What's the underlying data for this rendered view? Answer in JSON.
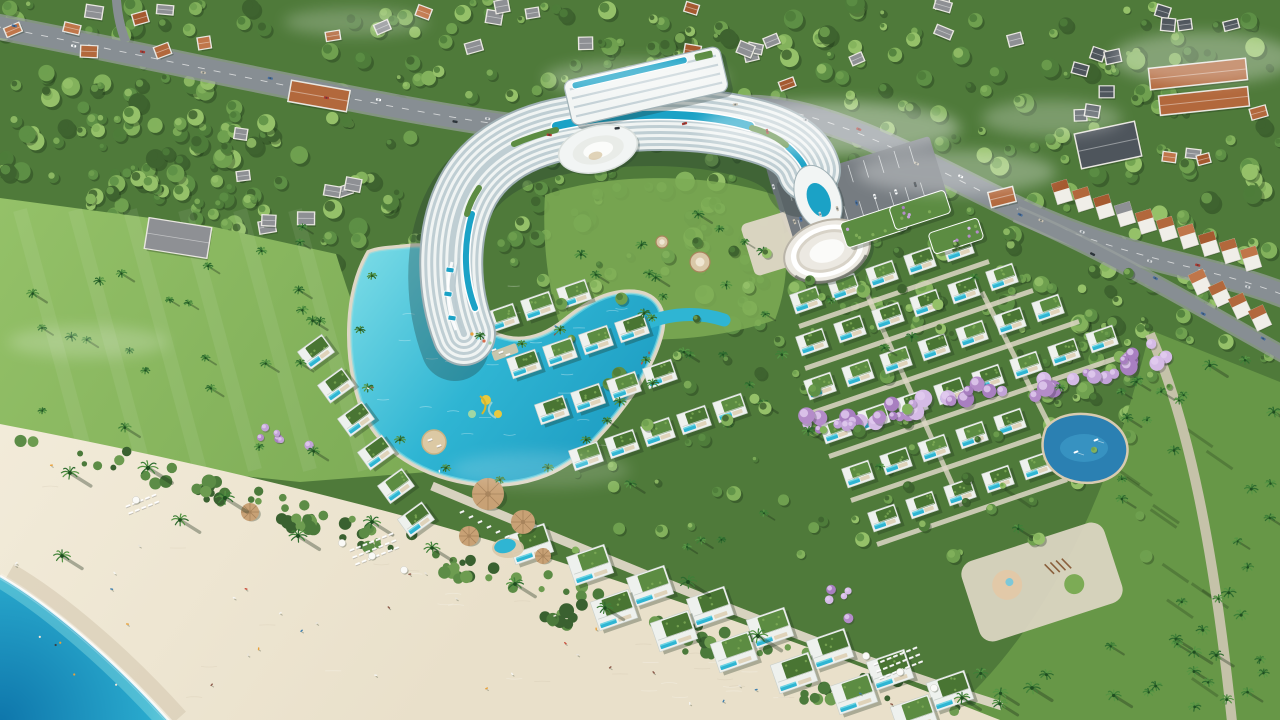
{
  "meta": {
    "type": "aerial-architectural-render",
    "subject": "beachfront resort complex with curved hotel, lagoon pools, villas, beach and sea"
  },
  "palette": {
    "forest_base": "#4f7a3a",
    "forest_cols": [
      "#3e632f",
      "#4e7c3a",
      "#5d8f45",
      "#6fa04f",
      "#83b25c",
      "#95c169"
    ],
    "shrub_cols": [
      "#3a6130",
      "#4b7a3b",
      "#5c8c46",
      "#6d9c50"
    ],
    "lawn": "#7cab55",
    "lawn_light": "#94c168",
    "lawn_dark": "#679747",
    "sand": "#e9e0ca",
    "sand_light": "#f2ebd9",
    "sand_wet": "#d9cdb6",
    "sand_grain": "#c9bda6",
    "sea_deep": "#0e76ab",
    "sea_mid": "#29a9cd",
    "sea_shallow": "#8fe2e4",
    "foam": "#ffffff",
    "road": "#878e93",
    "road_edge": "#9aa19e",
    "lane": "#e8eaea",
    "path": "#cfc7b4",
    "path_light": "#ded7c6",
    "villa_white": "#eef1ee",
    "villa_edge": "#c9d0cc",
    "deck": "#d9c8a8",
    "hotel_white": "#f2f5f4",
    "hotel_glass": "#bccbd1",
    "hotel_edge": "#9fb0b5",
    "rooftop_pool": "#1ba2c6",
    "pool": "#2fb5d3",
    "pool_light": "#7adbe6",
    "lagoon_deep": "#1895bd",
    "green_roof": "#5c8c42",
    "green_roof_dark": "#497533",
    "green_roof_light": "#7fad58",
    "purple_cols": [
      "#c2a3d8",
      "#b48cc9",
      "#d5bbe6",
      "#a87fc0"
    ],
    "tan": "#c8a175",
    "tan_dark": "#a8845c",
    "orange_roofs": [
      "#b2683c",
      "#a55a30",
      "#c0764a"
    ],
    "gray_roof": "#8e9094",
    "dark_roof": "#4e555c",
    "house_base": "#e9e7e1",
    "pond_deep": "#2b80b2",
    "pond_light": "#3f9ecb",
    "shadow": "rgba(25,45,22,0.35)",
    "car_cols": [
      "#ffffff",
      "#d8dadc",
      "#2e3338",
      "#b33a30",
      "#4a6f9e",
      "#c8c0b0"
    ],
    "people_cols": [
      "#e8e4da",
      "#c94f3e",
      "#e8a13c",
      "#3f7fae",
      "#f5f5f2",
      "#8c5a4a"
    ],
    "slide_yellow": "#e8c93e",
    "mist": "#ffffff"
  },
  "scene": {
    "seed": 7,
    "beach_d": "M 0,424 C 240,470 430,520 560,562 C 720,614 880,672 1005,722 L 0,722 Z",
    "sea_d": "M 0,576 C 52,606 118,664 170,722 L 0,722 Z",
    "shore_d": "M 0,576 C 52,606 118,664 170,722",
    "lawn_d": "M 0,198 L 210,226 L 336,254 C 360,330 392,420 428,472 L 300,482 L 150,466 L 0,436 Z",
    "corner_lawn_d": "M 1150,330 L 1280,382 L 1280,722 L 940,722 C 1042,640 1110,498 1150,330 Z",
    "courtyard_d": "M 545,195 C 600,175 700,170 775,195 C 790,240 790,280 775,320 C 700,345 620,345 560,325 C 548,290 542,240 545,195 Z",
    "lagoon_d": "M 370,254 C 348,292 346,352 362,402 C 378,450 426,476 478,482 C 530,486 566,468 594,438 C 622,408 648,372 658,338 C 666,312 656,296 634,294 C 608,292 586,306 566,322 C 546,338 524,346 500,338 C 474,330 458,306 456,278 C 454,256 436,246 412,248 C 394,250 380,250 370,254 Z",
    "lagoon_channel_d": "M 630,330 C 662,314 694,310 724,320",
    "hotel": {
      "band_d": "M 464,334 C 448,292 446,238 464,198 C 480,162 514,140 558,130 C 622,116 700,114 760,132 C 790,141 804,154 809,170",
      "roof_pools": [
        {
          "d": "M 556,126 C 618,112 696,110 750,126",
          "w": 8
        },
        {
          "d": "M 472,214 C 463,246 464,280 475,308",
          "w": 6
        },
        {
          "d": "M 788,147 C 797,155 803,162 806,170",
          "w": 6
        }
      ],
      "roof_greens": [
        {
          "d": "M 514,144 C 530,137 544,133 556,130",
          "w": 6
        },
        {
          "d": "M 752,128 C 766,132 778,138 786,145",
          "w": 6
        },
        {
          "d": "M 479,188 C 473,197 469,205 467,214",
          "w": 6
        }
      ],
      "wing": {
        "cx": 646,
        "cy": 86,
        "w": 160,
        "h": 46,
        "ang": -13
      },
      "shell": {
        "cx": 598,
        "cy": 149,
        "rx": 40,
        "ry": 23,
        "ang": -13
      },
      "podium": {
        "cx": 818,
        "cy": 198,
        "rx": 22,
        "ry": 34,
        "ang": -22
      }
    },
    "amphitheater": {
      "cx": 827,
      "cy": 251,
      "ang": -18
    },
    "roof_gardens": [
      {
        "x": 874,
        "y": 226,
        "w": 64,
        "h": 26
      },
      {
        "x": 920,
        "y": 210,
        "w": 58,
        "h": 24
      },
      {
        "x": 956,
        "y": 236,
        "w": 52,
        "h": 22
      }
    ],
    "parking": {
      "cx": 862,
      "cy": 190,
      "w": 160,
      "h": 64,
      "ang": -17
    },
    "pond_d": "M 1046,428 C 1038,448 1044,468 1064,478 C 1088,488 1114,482 1124,464 C 1132,448 1126,430 1108,420 C 1088,410 1058,412 1046,428 Z",
    "boats": [
      {
        "x": 1076,
        "y": 452
      },
      {
        "x": 1096,
        "y": 440
      }
    ],
    "playground": {
      "cx": 1042,
      "cy": 582,
      "w": 150,
      "h": 84,
      "ang": -18
    },
    "roads": {
      "highway": {
        "d": "M -6,26 C 220,70 420,118 560,132 C 660,141 700,104 760,108 C 850,114 960,185 1046,222 C 1140,262 1216,268 1286,296",
        "w": 21
      },
      "entrance": {
        "d": "M 757,107 C 768,150 776,190 792,226 C 798,238 802,244 806,250",
        "w": 12
      },
      "shop_road": {
        "d": "M 1016,214 C 1098,248 1190,302 1286,356",
        "w": 12
      },
      "side_road": {
        "d": "M 116,-6 C 117,12 120,28 126,42",
        "w": 9
      },
      "promenade": {
        "d": "M 432,486 C 600,556 800,642 1002,706",
        "w": 9
      },
      "right_path": {
        "d": "M 1150,334 C 1188,420 1214,548 1232,722",
        "w": 10
      }
    },
    "mists": [
      {
        "x": 830,
        "y": 128,
        "rx": 130,
        "ry": 27,
        "o": 0.38
      },
      {
        "x": 956,
        "y": 172,
        "rx": 100,
        "ry": 22,
        "o": 0.3
      },
      {
        "x": 636,
        "y": 78,
        "rx": 92,
        "ry": 18,
        "o": 0.28
      },
      {
        "x": 1204,
        "y": 58,
        "rx": 92,
        "ry": 26,
        "o": 0.3
      },
      {
        "x": 88,
        "y": 342,
        "rx": 80,
        "ry": 16,
        "o": 0.2
      },
      {
        "x": 356,
        "y": 22,
        "rx": 72,
        "ry": 14,
        "o": 0.22
      },
      {
        "x": 1052,
        "y": 118,
        "rx": 70,
        "ry": 18,
        "o": 0.25
      },
      {
        "x": 540,
        "y": 470,
        "rx": 90,
        "ry": 18,
        "o": 0.16
      }
    ],
    "house_clusters": [
      {
        "x": 10,
        "y": 2,
        "w": 340,
        "h": 56,
        "n": 9,
        "roofs": [
          "gray",
          "orange"
        ]
      },
      {
        "x": 380,
        "y": 6,
        "w": 240,
        "h": 50,
        "n": 7,
        "roofs": [
          "gray",
          "orange"
        ]
      },
      {
        "x": 640,
        "y": 2,
        "w": 250,
        "h": 86,
        "n": 9,
        "roofs": [
          "gray",
          "orange"
        ]
      },
      {
        "x": 898,
        "y": 2,
        "w": 130,
        "h": 46,
        "n": 4,
        "roofs": [
          "gray"
        ]
      },
      {
        "x": 1150,
        "y": 2,
        "w": 118,
        "h": 38,
        "n": 4,
        "roofs": [
          "dark"
        ]
      },
      {
        "x": 1048,
        "y": 28,
        "w": 96,
        "h": 88,
        "n": 6,
        "roofs": [
          "dark"
        ]
      },
      {
        "x": 220,
        "y": 130,
        "w": 200,
        "h": 110,
        "n": 8,
        "roofs": [
          "gray"
        ]
      },
      {
        "x": 1146,
        "y": 108,
        "w": 120,
        "h": 60,
        "n": 4,
        "roofs": [
          "orange",
          "gray"
        ]
      }
    ],
    "condos": [
      {
        "x": 1150,
        "y": 64,
        "w": 96,
        "h": 20,
        "ang": -6,
        "roof": "orange"
      },
      {
        "x": 1160,
        "y": 92,
        "w": 88,
        "h": 18,
        "ang": -6,
        "roof": "orange"
      },
      {
        "x": 290,
        "y": 86,
        "w": 58,
        "h": 20,
        "ang": 10,
        "roof": "orange"
      },
      {
        "x": 1078,
        "y": 128,
        "w": 60,
        "h": 34,
        "ang": -12,
        "roof": "dark"
      },
      {
        "x": 990,
        "y": 190,
        "w": 24,
        "h": 14,
        "ang": -14,
        "roof": "orange"
      }
    ],
    "shophouse_rows": [
      {
        "x": 1062,
        "y": 192,
        "n": 10,
        "dx": 21,
        "dy": 7.4,
        "ang": -17
      },
      {
        "x": 1200,
        "y": 282,
        "n": 4,
        "dx": 20,
        "dy": 12,
        "ang": -25
      }
    ],
    "villas": {
      "z1": {
        "start": [
          316,
          352
        ],
        "dx": 20,
        "dy": 33.5,
        "n": 6,
        "ang": -36,
        "w": 30,
        "h": 22
      },
      "z2": {
        "ang": -19,
        "w": 30,
        "h": 21,
        "col": [
          36,
          -12
        ],
        "rows": [
          {
            "start": [
              502,
              318
            ],
            "n": 3
          },
          {
            "start": [
              524,
              364
            ],
            "n": 4
          },
          {
            "start": [
              552,
              410
            ],
            "n": 4
          },
          {
            "start": [
              586,
              456
            ],
            "n": 5
          }
        ]
      },
      "z3": {
        "ang": -19,
        "w": 28,
        "h": 20,
        "col": [
          38,
          -13
        ],
        "rows": [
          {
            "start": [
              806,
              300
            ],
            "n": 5
          },
          {
            "start": [
              812,
              342
            ],
            "n": 6
          },
          {
            "start": [
              820,
              386
            ],
            "n": 7
          },
          {
            "start": [
              836,
              430
            ],
            "n": 8
          },
          {
            "start": [
              858,
              474
            ],
            "n": 5
          },
          {
            "start": [
              884,
              518
            ],
            "n": 5
          }
        ]
      },
      "z4": {
        "ang": -19,
        "w": 40,
        "h": 30,
        "col": [
          60,
          21
        ],
        "rows": [
          {
            "start": [
              530,
              544
            ],
            "n": 8
          },
          {
            "start": [
              614,
              610
            ],
            "n": 6
          }
        ]
      }
    },
    "purple_bands": [
      {
        "x1": 800,
        "y1": 428,
        "x2": 1005,
        "y2": 388,
        "n": 26,
        "rmin": 4,
        "rmax": 9
      },
      {
        "x1": 1012,
        "y1": 398,
        "x2": 1165,
        "y2": 352,
        "n": 20,
        "rmin": 4,
        "rmax": 9
      },
      {
        "x1": 254,
        "y1": 428,
        "x2": 300,
        "y2": 444,
        "n": 6,
        "rmin": 3,
        "rmax": 5
      },
      {
        "x1": 836,
        "y1": 598,
        "x2": 876,
        "y2": 626,
        "n": 5,
        "rmin": 3,
        "rmax": 5
      }
    ],
    "lounger_clusters": [
      {
        "x": 128,
        "y": 506,
        "ang": -22,
        "rows": 2,
        "cols": 5
      },
      {
        "x": 352,
        "y": 550,
        "ang": -22,
        "rows": 3,
        "cols": 7
      },
      {
        "x": 876,
        "y": 664,
        "ang": -22,
        "rows": 3,
        "cols": 7
      }
    ],
    "straw_umbrellas": [
      {
        "x": 250,
        "y": 512,
        "r": 9
      },
      {
        "x": 488,
        "y": 494,
        "r": 16
      },
      {
        "x": 523,
        "y": 522,
        "r": 12
      },
      {
        "x": 469,
        "y": 536,
        "r": 10
      },
      {
        "x": 543,
        "y": 556,
        "r": 8
      }
    ],
    "white_umbrellas": [
      {
        "x": 342,
        "y": 543
      },
      {
        "x": 372,
        "y": 556
      },
      {
        "x": 404,
        "y": 570
      },
      {
        "x": 866,
        "y": 656
      },
      {
        "x": 900,
        "y": 672
      },
      {
        "x": 934,
        "y": 688
      },
      {
        "x": 136,
        "y": 500
      }
    ],
    "beach_palms": [
      [
        70,
        473
      ],
      [
        148,
        468
      ],
      [
        225,
        498
      ],
      [
        298,
        536
      ],
      [
        372,
        522
      ],
      [
        432,
        548
      ],
      [
        515,
        584
      ],
      [
        605,
        608
      ],
      [
        688,
        582
      ],
      [
        758,
        636
      ],
      [
        962,
        698
      ],
      [
        1032,
        688
      ],
      [
        62,
        556
      ],
      [
        180,
        520
      ]
    ],
    "rim_palms": [
      [
        372,
        276
      ],
      [
        360,
        330
      ],
      [
        368,
        388
      ],
      [
        400,
        440
      ],
      [
        446,
        468
      ],
      [
        500,
        480
      ],
      [
        548,
        468
      ],
      [
        586,
        440
      ],
      [
        620,
        402
      ],
      [
        646,
        360
      ],
      [
        652,
        318
      ],
      [
        560,
        330
      ],
      [
        522,
        344
      ],
      [
        480,
        336
      ]
    ],
    "palm_fields": [
      {
        "x": 20,
        "y": 225,
        "w": 330,
        "h": 230,
        "n": 26,
        "s": 5
      },
      {
        "x": 560,
        "y": 205,
        "w": 210,
        "h": 120,
        "n": 12,
        "s": 5
      },
      {
        "x": 1160,
        "y": 360,
        "w": 115,
        "h": 350,
        "n": 22,
        "s": 6
      },
      {
        "x": 980,
        "y": 620,
        "w": 290,
        "h": 95,
        "n": 14,
        "s": 6
      },
      {
        "x": 600,
        "y": 270,
        "w": 560,
        "h": 280,
        "n": 30,
        "s": 5
      }
    ],
    "tree_fields": [
      {
        "x": 0,
        "y": 0,
        "w": 1280,
        "h": 330,
        "n": 470
      },
      {
        "x": 1040,
        "y": 280,
        "w": 240,
        "h": 170,
        "n": 55
      },
      {
        "x": 0,
        "y": 60,
        "w": 240,
        "h": 190,
        "n": 60
      }
    ],
    "inner_tree_field": {
      "x": 560,
      "y": 240,
      "w": 620,
      "h": 320,
      "n": 110
    },
    "shrub_clumps": [
      [
        300,
        525
      ],
      [
        460,
        570
      ],
      [
        560,
        615
      ],
      [
        700,
        650
      ],
      [
        820,
        690
      ],
      [
        210,
        490
      ]
    ],
    "pavilions": [
      {
        "x": 700,
        "y": 262,
        "r": 10
      },
      {
        "x": 662,
        "y": 242,
        "r": 6
      }
    ],
    "counts": {
      "beach_people": 34,
      "swimmers": 5,
      "pool_people": 8,
      "highway_cars": 22,
      "shop_cars": 5,
      "entrance_cars": 3
    }
  }
}
